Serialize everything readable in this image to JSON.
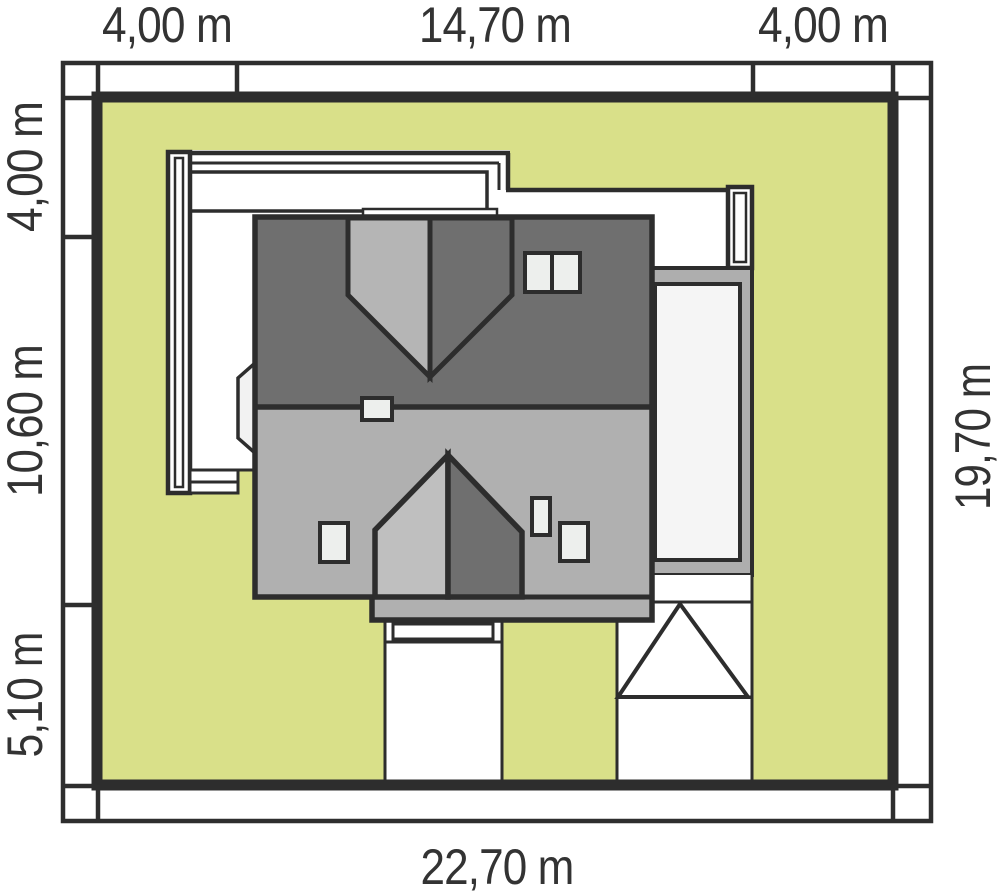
{
  "plan": {
    "type": "house-site-plan",
    "dimensions": {
      "top_left": "4,00 m",
      "top_center": "14,70 m",
      "top_right": "4,00 m",
      "left_top": "4,00 m",
      "left_middle": "10,60 m",
      "left_bottom": "5,10 m",
      "right_side": "19,70 m",
      "bottom": "22,70 m"
    },
    "plot": {
      "width_label": "22,70 m",
      "depth_label": "19,70 m",
      "setbacks": [
        "4,00 m",
        "14,70 m",
        "4,00 m",
        "4,00 m",
        "10,60 m",
        "5,10 m"
      ]
    },
    "colors": {
      "lawn": "#d9e089",
      "roof_dark": "#6f6f6f",
      "roof_light": "#b0b0b0",
      "gable_light": "#bfbfbf",
      "dormer_light": "#b5b5b5",
      "pergola_frame": "#aeaeae",
      "pergola_inner": "#f5f5f5",
      "paving": "#ffffff",
      "skylight": "#edefed",
      "bay_window": "#f2f2f2",
      "outline": "#2d2d2d",
      "label_text": "#333333"
    }
  }
}
